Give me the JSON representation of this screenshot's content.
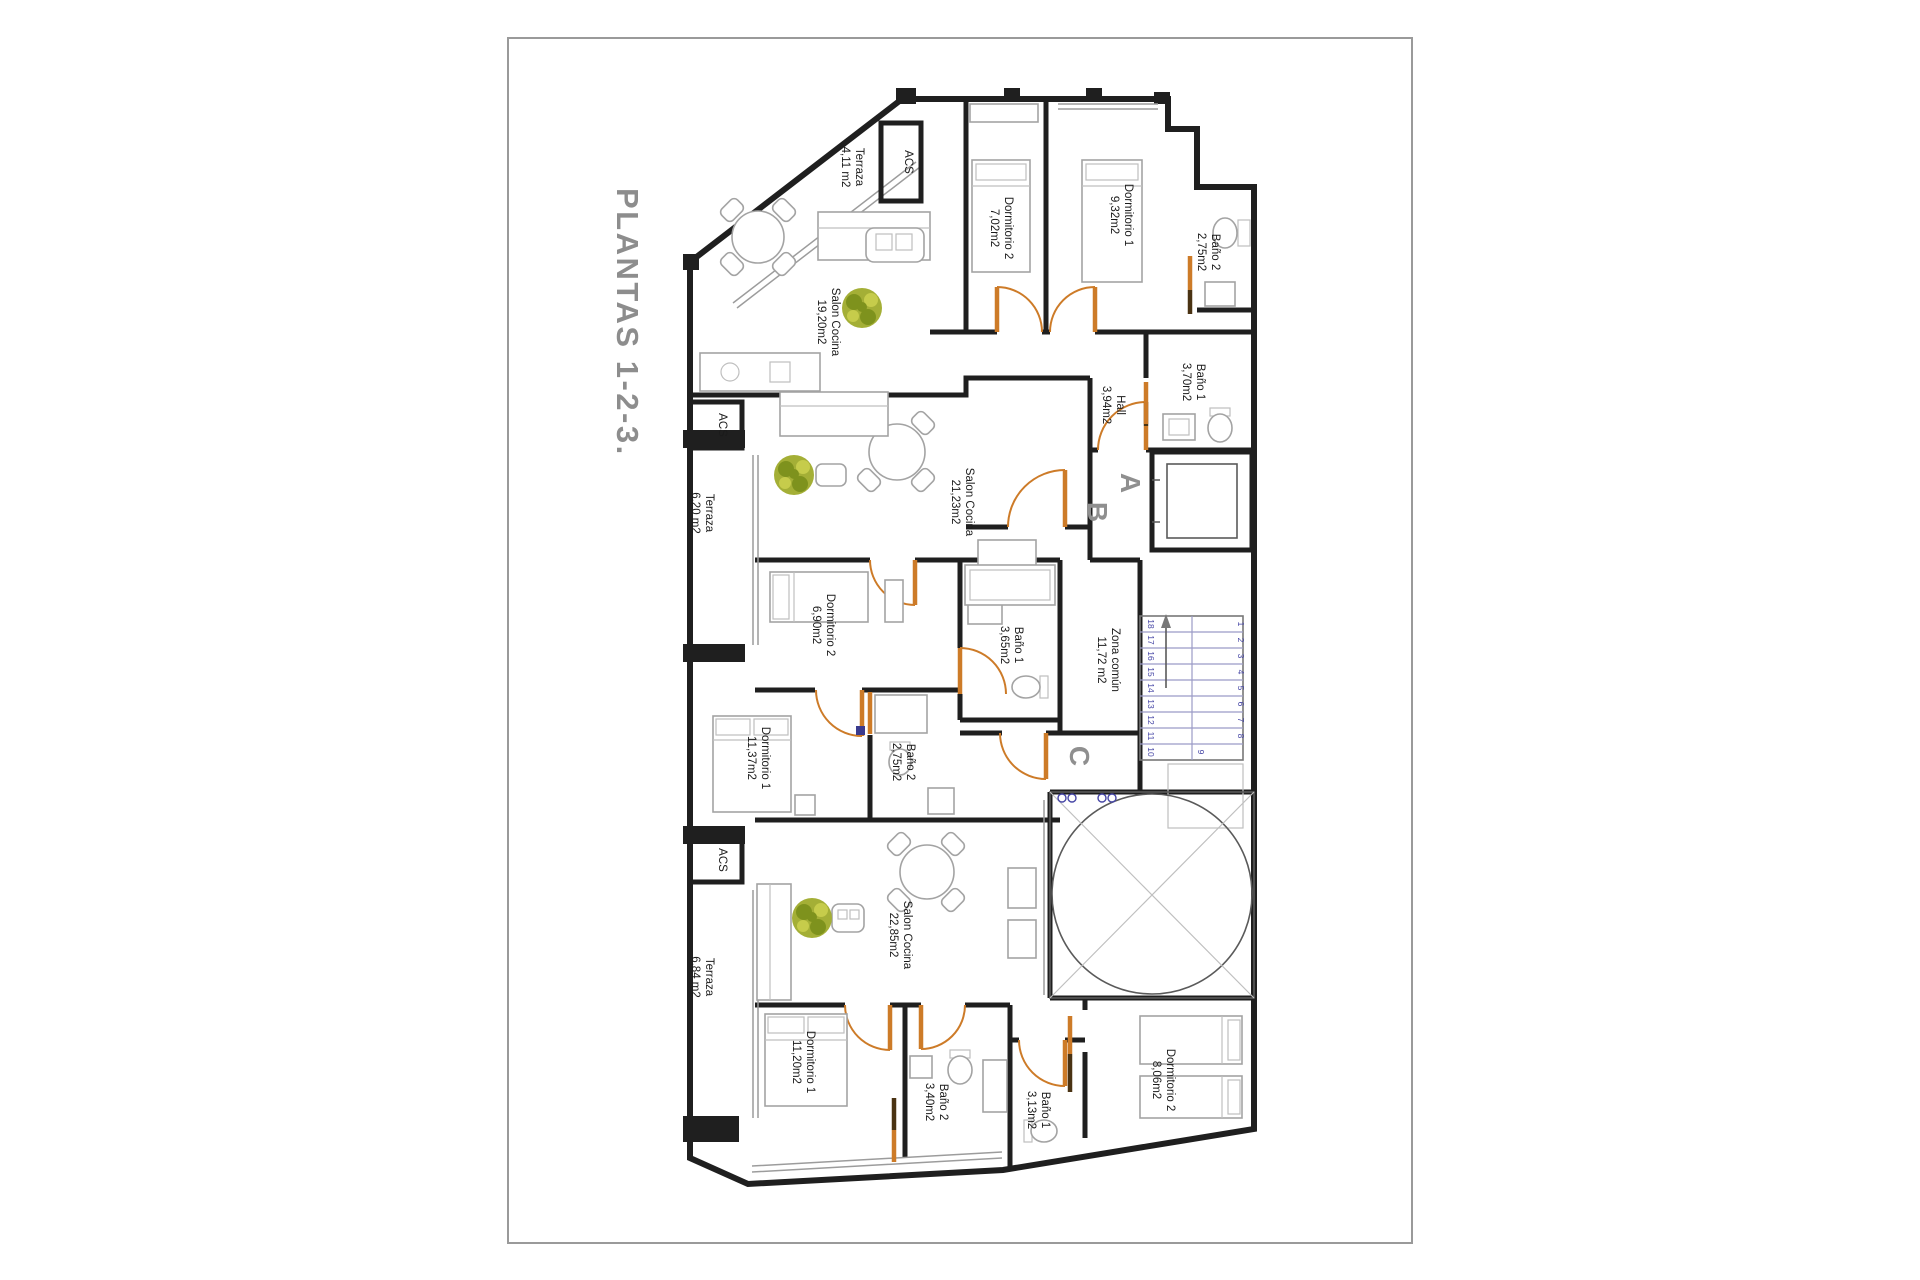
{
  "title": "PLANTAS 1-2-3.",
  "units": [
    {
      "letter": "A",
      "rooms": {
        "terraza": {
          "name": "Terraza",
          "area": "4,11 m2"
        },
        "acs": {
          "name": "ACS"
        },
        "dorm2": {
          "name": "Dormitorio 2",
          "area": "7,02m2"
        },
        "dorm1": {
          "name": "Dormitorio 1",
          "area": "9,32m2"
        },
        "bano2": {
          "name": "Baño 2",
          "area": "2,75m2"
        },
        "salon": {
          "name": "Salon Cocina",
          "area": "19,20m2"
        },
        "bano1": {
          "name": "Baño 1",
          "area": "3,70m2"
        },
        "hall": {
          "name": "Hall",
          "area": "3,94m2"
        }
      }
    },
    {
      "letter": "B",
      "rooms": {
        "acs": {
          "name": "ACS"
        },
        "terraza": {
          "name": "Terraza",
          "area": "6,20 m2"
        },
        "salon": {
          "name": "Salon Cocina",
          "area": "21,23m2"
        },
        "dorm2": {
          "name": "Dormitorio 2",
          "area": "6,90m2"
        },
        "bano1": {
          "name": "Baño 1",
          "area": "3,65m2"
        },
        "dorm1": {
          "name": "Dormitorio 1",
          "area": "11,37m2"
        },
        "bano2": {
          "name": "Baño 2",
          "area": "2,75m2"
        }
      }
    },
    {
      "letter": "C",
      "rooms": {
        "acs": {
          "name": "ACS"
        },
        "terraza": {
          "name": "Terraza",
          "area": "6,84 m2"
        },
        "salon": {
          "name": "Salon Cocina",
          "area": "22,85m2"
        },
        "dorm1": {
          "name": "Dormitorio 1",
          "area": "11,20m2"
        },
        "bano2": {
          "name": "Baño 2",
          "area": "3,40m2"
        },
        "bano1": {
          "name": "Baño 1",
          "area": "3,13m2"
        },
        "dorm2": {
          "name": "Dormitorio 2",
          "area": "8,06m2"
        }
      }
    }
  ],
  "common": {
    "zona": {
      "name": "Zona común",
      "area": "11,72 m2"
    },
    "stairs": {
      "numbers": [
        "1",
        "2",
        "3",
        "4",
        "5",
        "6",
        "7",
        "8",
        "9",
        "10",
        "11",
        "12",
        "13",
        "14",
        "15",
        "16",
        "17",
        "18"
      ]
    }
  },
  "colors": {
    "wall": "#1f1f1f",
    "door": "#cd7b28",
    "stair_text": "#4545a5",
    "plant": "#a4af36",
    "title_gray": "#8d8d8d"
  }
}
